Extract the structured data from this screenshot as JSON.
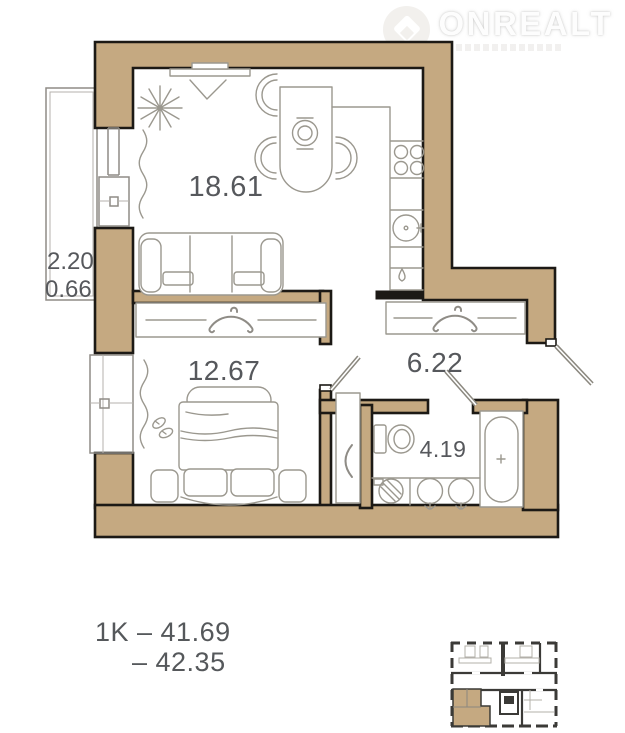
{
  "logo": {
    "brand": "ONREALT"
  },
  "plan": {
    "rooms": {
      "living_kitchen": {
        "area": "18.61"
      },
      "bedroom": {
        "area": "12.67"
      },
      "hall": {
        "area": "6.22"
      },
      "bathroom": {
        "area": "4.19"
      },
      "balcony": {
        "area_glazed": "2.20",
        "area_coeff": "0.66"
      }
    }
  },
  "summary": {
    "line1": "1K – 41.69",
    "line2": "– 42.35"
  },
  "colors": {
    "wall": "#c5a981",
    "outline": "#1c1915",
    "furniture_line": "#9b988f",
    "label_text": "#56585c",
    "miniplan_wall": "#3b3a37"
  }
}
